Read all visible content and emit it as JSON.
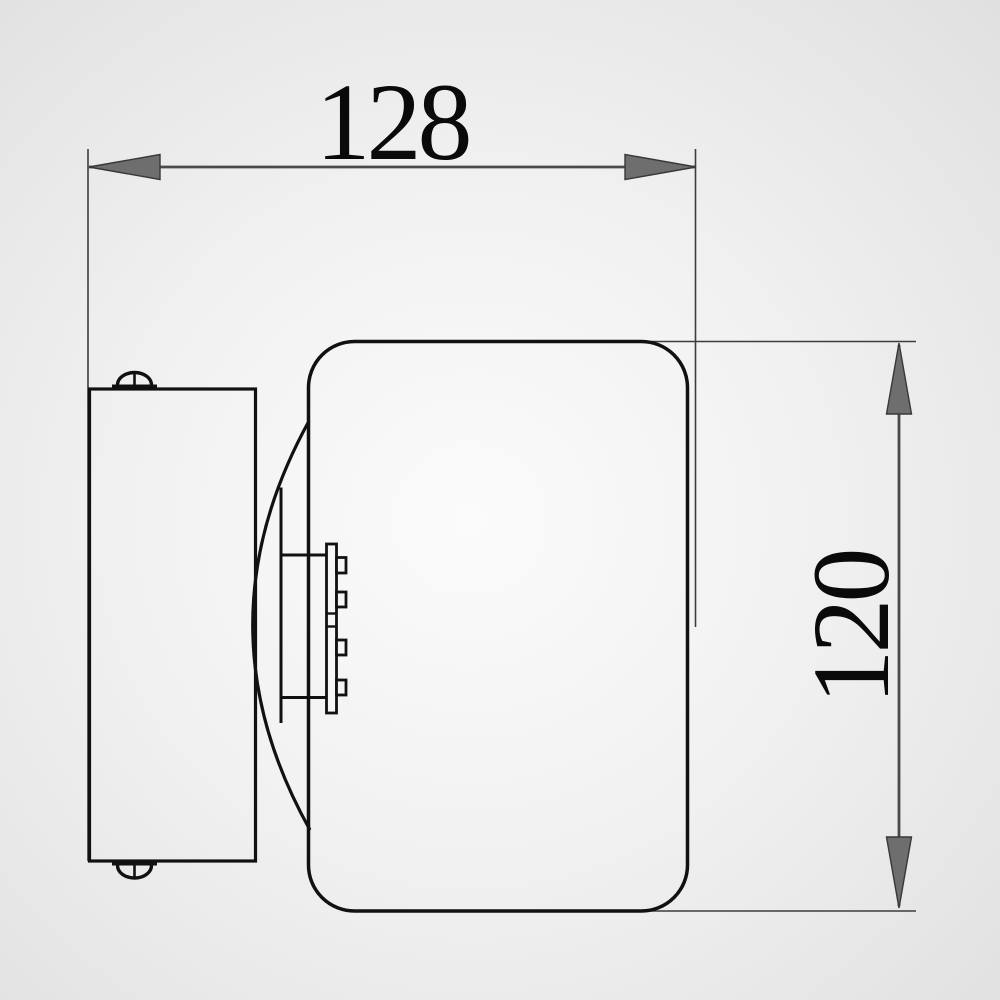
{
  "dimensions": {
    "width": {
      "label": "128"
    },
    "height": {
      "label": "120"
    }
  },
  "colors": {
    "object_line": "#111111",
    "dimension_line": "#4a4a4a",
    "extension_line": "#3d3d3d",
    "arrowhead_fill": "#6e6e6e",
    "label_text": "#0a0a0a",
    "background_center": "#fbfbfb",
    "background_edge": "#e0e0e0"
  }
}
